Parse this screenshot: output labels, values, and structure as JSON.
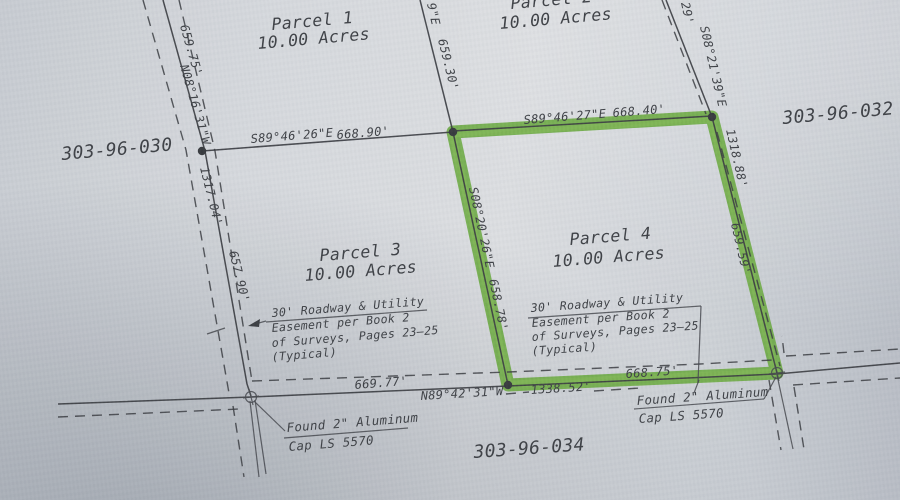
{
  "document_type": "survey-plat-photo",
  "colors": {
    "paper": "#d3d6da",
    "ink": "#3b3e43",
    "highlight_green": "#69a83d"
  },
  "parcels": [
    {
      "name": "Parcel 1",
      "acreage": "10.00 Acres"
    },
    {
      "name": "Parcel 2",
      "acreage": "10.00 Acres"
    },
    {
      "name": "Parcel 3",
      "acreage": "10.00 Acres"
    },
    {
      "name": "Parcel 4",
      "acreage": "10.00 Acres",
      "highlighted": true
    }
  ],
  "apns": {
    "west": "303-96-030",
    "east": "303-96-032",
    "south": "303-96-034"
  },
  "bearings": {
    "north_line_west": {
      "bearing": "S89°46'26\"E",
      "distance": "668.90'"
    },
    "north_line_east": {
      "bearing": "S89°46'27\"E",
      "distance": "668.40'"
    },
    "west_line": {
      "top_distance": "659.75'",
      "bearing": "N08°16'31\"W",
      "middle_distance": "1317.04'",
      "south_distance": "657.90'"
    },
    "center_line": {
      "partial_bearing": "9\"E",
      "distance": "659.30'"
    },
    "east_line": {
      "partial_top": "29'",
      "bearing": "S08°21'39\"E",
      "total_distance": "1318.88'",
      "parcel4_distance": "659.59'"
    },
    "parcel4_west": {
      "bearing": "S08°20'26\"E",
      "distance": "658.78'"
    },
    "south_line": {
      "west_distance": "669.77'",
      "bearing": "N89°42'31\"W",
      "total_distance": "1338.52'",
      "parcel4_distance": "668.75'"
    }
  },
  "notes": {
    "easement": {
      "line1": "30' Roadway & Utility",
      "line2": "Easement per Book 2",
      "line3": "of Surveys, Pages 23–25",
      "line4": "(Typical)"
    },
    "monument": {
      "line1": "Found 2\" Aluminum",
      "line2": "Cap LS 5570"
    }
  }
}
